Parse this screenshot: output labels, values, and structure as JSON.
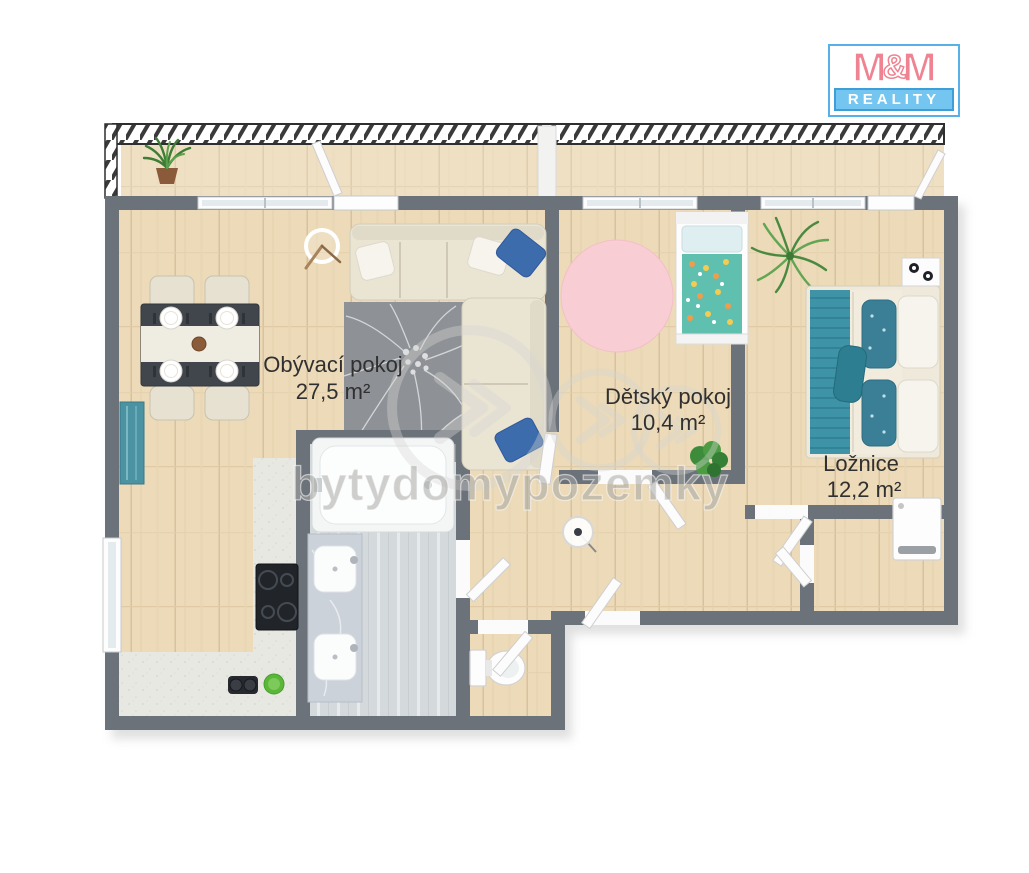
{
  "logo": {
    "m1": "M",
    "amp": "&",
    "m2": "M",
    "tagline": "REALITY"
  },
  "watermark": {
    "text": "bytydomypozemky"
  },
  "rooms": {
    "living": {
      "name": "Obývací pokoj",
      "area": "27,5 m²"
    },
    "kids": {
      "name": "Dětský pokoj",
      "area": "10,4 m²"
    },
    "bedroom": {
      "name": "Ložnice",
      "area": "12,2 m²"
    }
  },
  "colors": {
    "brand_pink": "#ef8391",
    "brand_blue": "#57b0e8",
    "tagline_bg": "#74c6f0",
    "wall_gray": "#6c727a",
    "floor_wood": "#ecdab8",
    "accent_teal": "#3f93a7",
    "rug_gray": "#8e9297",
    "kids_rug_pink": "#f8cdd4"
  }
}
